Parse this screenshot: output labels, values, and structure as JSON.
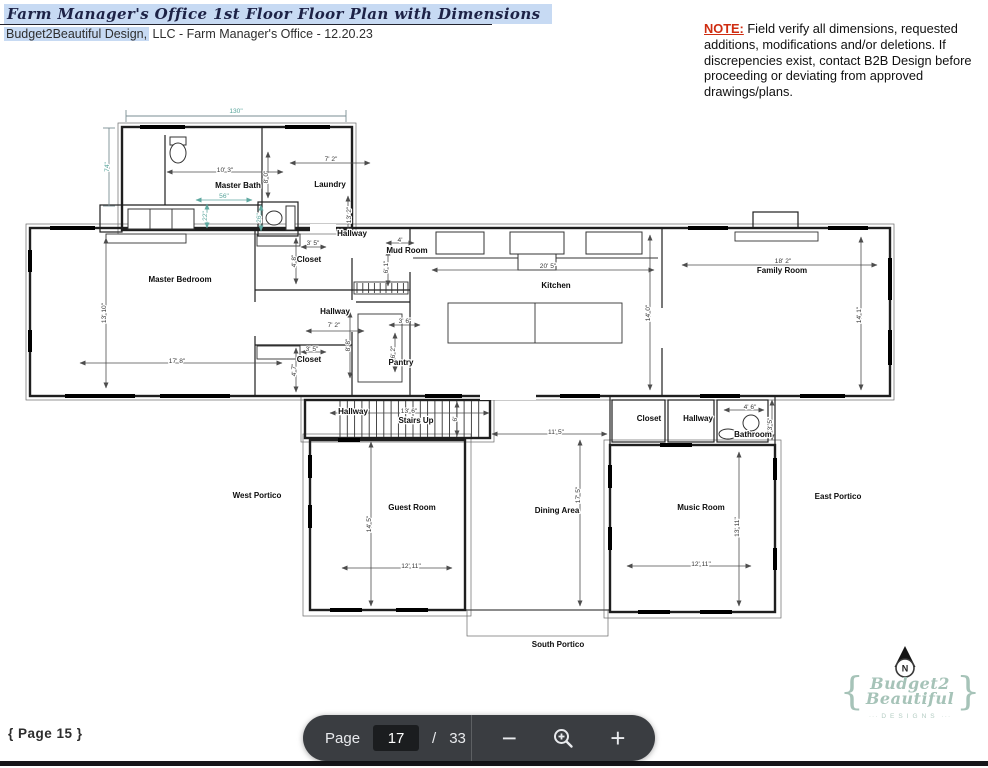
{
  "header": {
    "title": "Farm Manager's Office 1st Floor Floor Plan with Dimensions",
    "subtitle_highlight": "Budget2Beautiful Design,",
    "subtitle_rest": " LLC - Farm Manager's Office - 12.20.23"
  },
  "note": {
    "label": "NOTE:",
    "text": " Field verify all dimensions, requested additions, modifications and/or deletions. If discrepencies exist, contact B2B Design before proceeding or deviating from approved drawings/plans."
  },
  "floorplan": {
    "teal_color": "#57a49b",
    "labels": [
      {
        "t": "Master Bath",
        "x": 238,
        "y": 188,
        "k": "room"
      },
      {
        "t": "Laundry",
        "x": 330,
        "y": 187,
        "k": "room"
      },
      {
        "t": "Hallway",
        "x": 352,
        "y": 236,
        "k": "room"
      },
      {
        "t": "Mud Room",
        "x": 407,
        "y": 253,
        "k": "room"
      },
      {
        "t": "Closet",
        "x": 309,
        "y": 262,
        "k": "room"
      },
      {
        "t": "Master Bedroom",
        "x": 180,
        "y": 282,
        "k": "room"
      },
      {
        "t": "Kitchen",
        "x": 556,
        "y": 288,
        "k": "room"
      },
      {
        "t": "Family Room",
        "x": 782,
        "y": 273,
        "k": "room"
      },
      {
        "t": "Hallway",
        "x": 335,
        "y": 314,
        "k": "room"
      },
      {
        "t": "Closet",
        "x": 309,
        "y": 362,
        "k": "room"
      },
      {
        "t": "Pantry",
        "x": 401,
        "y": 365,
        "k": "room"
      },
      {
        "t": "Hallway",
        "x": 353,
        "y": 414,
        "k": "room"
      },
      {
        "t": "Stairs Up",
        "x": 416,
        "y": 423,
        "k": "room"
      },
      {
        "t": "Closet",
        "x": 649,
        "y": 421,
        "k": "room"
      },
      {
        "t": "Hallway",
        "x": 698,
        "y": 421,
        "k": "room"
      },
      {
        "t": "Bathroom",
        "x": 753,
        "y": 437,
        "k": "room"
      },
      {
        "t": "West Portico",
        "x": 257,
        "y": 498,
        "k": "room"
      },
      {
        "t": "Guest Room",
        "x": 412,
        "y": 510,
        "k": "room"
      },
      {
        "t": "Dining Area",
        "x": 557,
        "y": 513,
        "k": "room"
      },
      {
        "t": "Music Room",
        "x": 701,
        "y": 510,
        "k": "room"
      },
      {
        "t": "East Portico",
        "x": 838,
        "y": 499,
        "k": "room"
      },
      {
        "t": "South Portico",
        "x": 558,
        "y": 647,
        "k": "room"
      },
      {
        "t": "130\"",
        "x": 236,
        "y": 113,
        "k": "teal"
      },
      {
        "t": "74\"",
        "x": 109,
        "y": 167,
        "k": "teal",
        "r": -90
      },
      {
        "t": "10' 3\"",
        "x": 225,
        "y": 172,
        "k": "dim"
      },
      {
        "t": "8' 0\"",
        "x": 268,
        "y": 177,
        "k": "dim",
        "r": -90
      },
      {
        "t": "7' 2\"",
        "x": 331,
        "y": 161,
        "k": "dim"
      },
      {
        "t": "56\"",
        "x": 224,
        "y": 198,
        "k": "teal"
      },
      {
        "t": "22\"",
        "x": 207,
        "y": 216,
        "k": "teal",
        "r": -90
      },
      {
        "t": "26\"",
        "x": 261,
        "y": 218,
        "k": "teal",
        "r": -90
      },
      {
        "t": "13' 2\"",
        "x": 351,
        "y": 215,
        "k": "dim",
        "r": -90
      },
      {
        "t": "4'",
        "x": 400,
        "y": 242,
        "k": "dim"
      },
      {
        "t": "6' 1\"",
        "x": 388,
        "y": 267,
        "k": "dim",
        "r": -90
      },
      {
        "t": "3' 5\"",
        "x": 313,
        "y": 245,
        "k": "dim"
      },
      {
        "t": "4' 8\"",
        "x": 296,
        "y": 261,
        "k": "dim",
        "r": -90
      },
      {
        "t": "13' 10\"",
        "x": 106,
        "y": 313,
        "k": "dim",
        "r": -90
      },
      {
        "t": "17' 8\"",
        "x": 177,
        "y": 363,
        "k": "dim"
      },
      {
        "t": "7' 2\"",
        "x": 334,
        "y": 327,
        "k": "dim"
      },
      {
        "t": "3' 5\"",
        "x": 312,
        "y": 351,
        "k": "dim"
      },
      {
        "t": "4' 7\"",
        "x": 296,
        "y": 370,
        "k": "dim",
        "r": -90
      },
      {
        "t": "3' 6\"",
        "x": 405,
        "y": 323,
        "k": "dim"
      },
      {
        "t": "6' 2\"",
        "x": 395,
        "y": 352,
        "k": "dim",
        "r": -90
      },
      {
        "t": "8' 8\"",
        "x": 350,
        "y": 345,
        "k": "dim",
        "r": -90
      },
      {
        "t": "20' 5\"",
        "x": 548,
        "y": 268,
        "k": "dim"
      },
      {
        "t": "14' 0\"",
        "x": 650,
        "y": 313,
        "k": "dim",
        "r": -90
      },
      {
        "t": "18' 2\"",
        "x": 783,
        "y": 263,
        "k": "dim"
      },
      {
        "t": "14' 1\"",
        "x": 861,
        "y": 315,
        "k": "dim",
        "r": -90
      },
      {
        "t": "13' 6\"",
        "x": 409,
        "y": 413,
        "k": "dim"
      },
      {
        "t": "6'",
        "x": 457,
        "y": 419,
        "k": "dim",
        "r": -90
      },
      {
        "t": "11' 5\"",
        "x": 556,
        "y": 434,
        "k": "dim"
      },
      {
        "t": "4' 6\"",
        "x": 750,
        "y": 409,
        "k": "dim"
      },
      {
        "t": "3' 5\"",
        "x": 772,
        "y": 424,
        "k": "dim",
        "r": -90
      },
      {
        "t": "14' 5\"",
        "x": 371,
        "y": 524,
        "k": "dim",
        "r": -90
      },
      {
        "t": "12' 11\"",
        "x": 411,
        "y": 568,
        "k": "dim"
      },
      {
        "t": "17' 5\"",
        "x": 580,
        "y": 495,
        "k": "dim",
        "r": -90
      },
      {
        "t": "13' 11\"",
        "x": 739,
        "y": 527,
        "k": "dim",
        "r": -90
      },
      {
        "t": "12' 11\"",
        "x": 701,
        "y": 566,
        "k": "dim"
      }
    ]
  },
  "compass": {
    "label": "N"
  },
  "logo": {
    "brace_left": "{",
    "line1": "Budget2",
    "line2": "Beautiful",
    "sub": "DESIGNS",
    "brace_right": "}",
    "color": "#a6c3b8"
  },
  "pager": {
    "prev_label": "{ Page 15 }"
  },
  "toolbar": {
    "page_label": "Page",
    "current_page": "17",
    "separator": "/",
    "total_pages": "33",
    "zoom_out": "−",
    "zoom_in": "+"
  }
}
